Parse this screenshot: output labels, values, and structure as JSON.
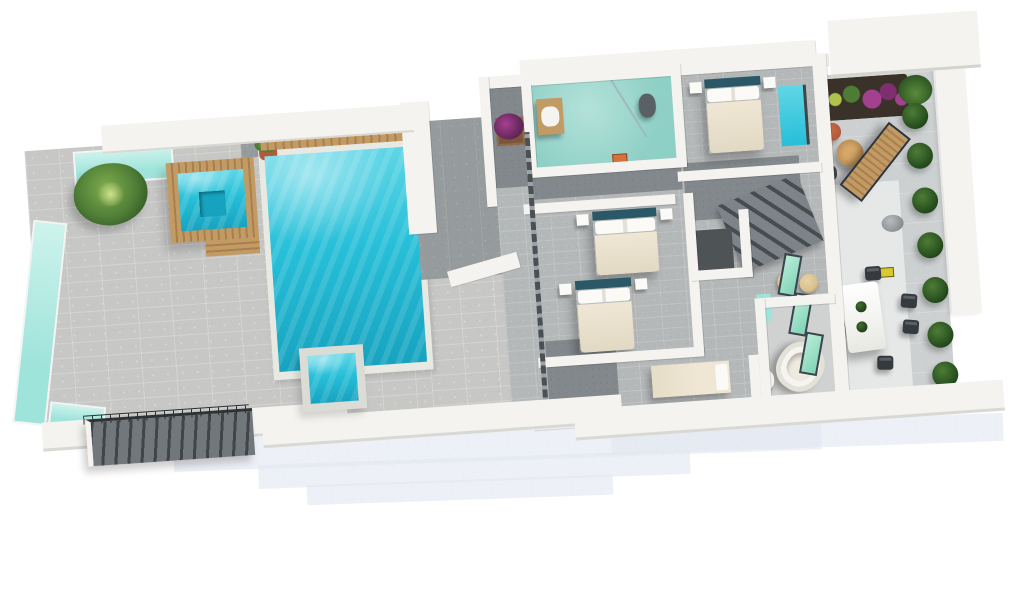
{
  "scene": {
    "description": "3D rendered top-down floor plan of a villa level: pool terrace with jacuzzi and sun loungers on the left, four bedrooms with two bathrooms in the centre, rear garden terrace with dining set on the right, ghost outline of the storey below underneath",
    "background": "#ffffff"
  },
  "colors": {
    "pool_water": "#27bfd8",
    "pool_water_light": "#5fd6e6",
    "pool_water_deep": "#17a3bf",
    "glass_railing": "#9fe4db",
    "glass_door_green": "#7fd3b4",
    "terrace_tile": "#c7c7c6",
    "terrace_tile_shadow": "#969b9d",
    "interior_floor": "#b5b8b9",
    "interior_floor_dark": "#82888b",
    "wall": "#f4f3ef",
    "wall_shadow": "#d9d8d2",
    "wood": "#c29a63",
    "wood_dark": "#a97f4e",
    "bed_duvet": "#efe7d4",
    "bed_headboard": "#2b5867",
    "bathroom_floor": "#8fd0c6",
    "stairs_dark": "#3f4549",
    "plant_green": "#4e7c36",
    "flower_purple": "#a4418f",
    "terracotta": "#b05a3c",
    "tub_white": "#f6f4ee",
    "lower_floor_ghost": "#e3e7f1",
    "dining_chair": "#343a3e",
    "lounger_white": "#f6f4ee",
    "lounger_frame": "#8a7a5e",
    "rattan": "#d8c08e",
    "sign_yellow": "#d8c832"
  },
  "furniture": {
    "left_loungers": {
      "container": "left-loungers",
      "item_class": "lounger",
      "item_name": "sun-lounger",
      "items": [
        {
          "x": 101,
          "y": 152,
          "r": 17
        },
        {
          "x": 94,
          "y": 199,
          "r": 17
        },
        {
          "x": 93,
          "y": 245,
          "r": 17
        },
        {
          "x": 86,
          "y": 284,
          "r": 17
        }
      ]
    },
    "left_tables": {
      "container": "left-tables",
      "item_class": "side-table",
      "item_name": "side-table",
      "items": [
        {
          "x": 135,
          "y": 184,
          "r": 17
        },
        {
          "x": 128,
          "y": 229,
          "r": 17
        }
      ]
    },
    "mid_loungers": {
      "container": "mid-loungers",
      "item_class": "lounger",
      "item_name": "sun-lounger",
      "items": [
        {
          "x": 418,
          "y": 219,
          "r": -34
        },
        {
          "x": 398,
          "y": 271,
          "r": -34
        }
      ]
    },
    "mid_tables": {
      "container": "mid-loungers",
      "item_class": "side-table",
      "item_name": "side-table",
      "items": [
        {
          "x": 447,
          "y": 246,
          "r": -34
        }
      ]
    },
    "dining_chairs": {
      "container": "dining-chairs",
      "item_class": "dining-chair",
      "item_name": "dining-chair",
      "items": [
        {
          "x": 0,
          "y": 226,
          "r": -8
        },
        {
          "x": 0,
          "y": 252,
          "r": -8
        },
        {
          "x": 58,
          "y": 232,
          "r": 8
        },
        {
          "x": 58,
          "y": 258,
          "r": 8
        },
        {
          "x": 24,
          "y": 202,
          "r": 0
        },
        {
          "x": 30,
          "y": 292,
          "r": 4
        }
      ]
    },
    "table_plants": {
      "container": "dining-table",
      "item_class": "table-plant",
      "item_name": "table-plant-pot",
      "items": [
        {
          "x": 13,
          "y": 18,
          "r": 0
        },
        {
          "x": 11,
          "y": 38,
          "r": 0
        }
      ]
    },
    "shrubs": {
      "container": "shrub-row",
      "item_class": "shrub",
      "item_name": "shrub",
      "items": [
        {
          "x": 88,
          "y": 42,
          "r": 0
        },
        {
          "x": 90,
          "y": 82,
          "r": 0
        },
        {
          "x": 92,
          "y": 127,
          "r": 0
        },
        {
          "x": 94,
          "y": 172,
          "r": 0
        },
        {
          "x": 96,
          "y": 217,
          "r": 0
        },
        {
          "x": 98,
          "y": 262,
          "r": 0
        },
        {
          "x": 100,
          "y": 302,
          "r": 0
        }
      ]
    },
    "glass_doors": {
      "container": "door-panels",
      "item_class": "glass-door-panel",
      "item_name": "bifold-glass-door-panel",
      "items": [
        {
          "x": 288,
          "y": 198,
          "r": 14
        },
        {
          "x": 296,
          "y": 238,
          "r": 14
        },
        {
          "x": 304,
          "y": 278,
          "r": 14
        }
      ]
    }
  }
}
